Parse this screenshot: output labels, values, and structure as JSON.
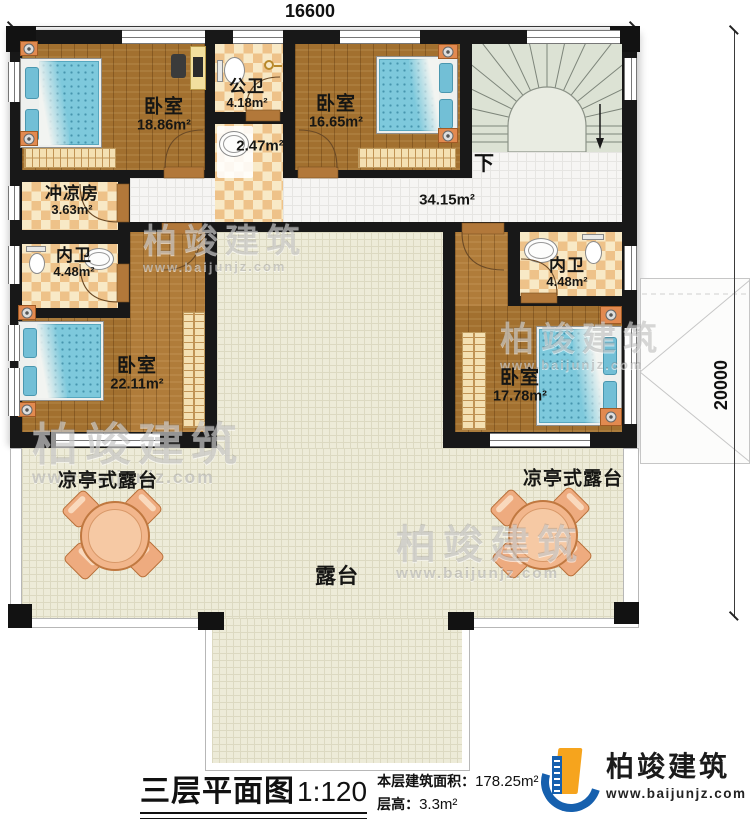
{
  "dimensions": {
    "width": "16600",
    "height": "20000"
  },
  "rooms": {
    "bedroom_tl": {
      "name": "卧室",
      "area": "18.86m²"
    },
    "public_bath": {
      "name": "公卫",
      "area": "4.18m²"
    },
    "washroom": {
      "area": "2.47m²"
    },
    "bedroom_tr": {
      "name": "卧室",
      "area": "16.65m²"
    },
    "shower_room": {
      "name": "冲凉房",
      "area": "3.63m²"
    },
    "ensuite_left": {
      "name": "内卫",
      "area": "4.48m²"
    },
    "bedroom_ml": {
      "name": "卧室",
      "area": "22.11m²"
    },
    "ensuite_right": {
      "name": "内卫",
      "area": "4.48m²"
    },
    "bedroom_mr": {
      "name": "卧室",
      "area": "17.78m²"
    },
    "hallway": {
      "area": "34.15m²"
    },
    "stairs": {
      "direction": "下"
    },
    "pavilion_left": {
      "name": "凉亭式露台"
    },
    "pavilion_right": {
      "name": "凉亭式露台"
    },
    "terrace": {
      "name": "露台"
    }
  },
  "title": {
    "main": "三层平面图",
    "scale": "1:120",
    "floor_area_label": "本层建筑面积：",
    "floor_area": "178.25m²",
    "height_label": "层高：",
    "height": "3.3m²"
  },
  "logo": {
    "name": "柏竣建筑",
    "website": "www.baijunjz.com"
  },
  "watermark": {
    "text": "柏竣建筑",
    "url": "www.baijunjz.com"
  },
  "colors": {
    "wall": "#181818",
    "wood_floor": "#a2702f",
    "bath_tile": "#eec289",
    "terrace": "#edebd8",
    "bed": "#7ec9dc",
    "logo_blue": "#1660ae",
    "logo_orange": "#f6a41d"
  }
}
